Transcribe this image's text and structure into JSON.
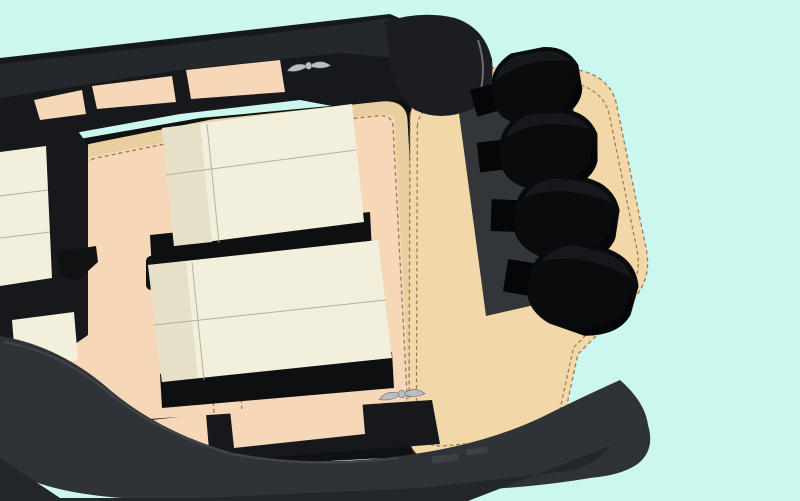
{
  "scene": {
    "description": "Overhead 3D render of a rigid inflatable yacht tender with cream sun-pad seating, stitched tan deck trim, a stern swim platform and four black outboard engines",
    "view": "top-down",
    "engine_count": 4,
    "emblem": "winged-crest"
  },
  "colors": {
    "background": "#cbf7ef",
    "frame_black": "#17181b",
    "bulwark_black": "#101113",
    "tube_top": "#24272b",
    "cap_black": "#1b1d20",
    "cap_edge": "#6a6f73",
    "deck_peach": "#f6d7b8",
    "trim_tan": "#e9cfa0",
    "platform_tan": "#f2d8a8",
    "stitch_brown": "#8a6a45",
    "seat_cream": "#f2efdd",
    "seat_shade": "#e6e0c8",
    "seat_seam": "#a9a188",
    "seat_base": "#0e0f11",
    "tube_gray": "#2f3236",
    "tube_edge": "#41454a",
    "hull_bottom": "#24272a",
    "transom_gray": "#333639",
    "engine_black": "#0a0b0d",
    "engine_facet": "#16181b",
    "engine_dark": "#050607",
    "emblem_silver": "#b9bec3",
    "emblem_line": "#585d61",
    "fitting_gray": "#a4a8ab",
    "cleat_black": "#2a2d30",
    "vent_gray": "#3d4145"
  }
}
